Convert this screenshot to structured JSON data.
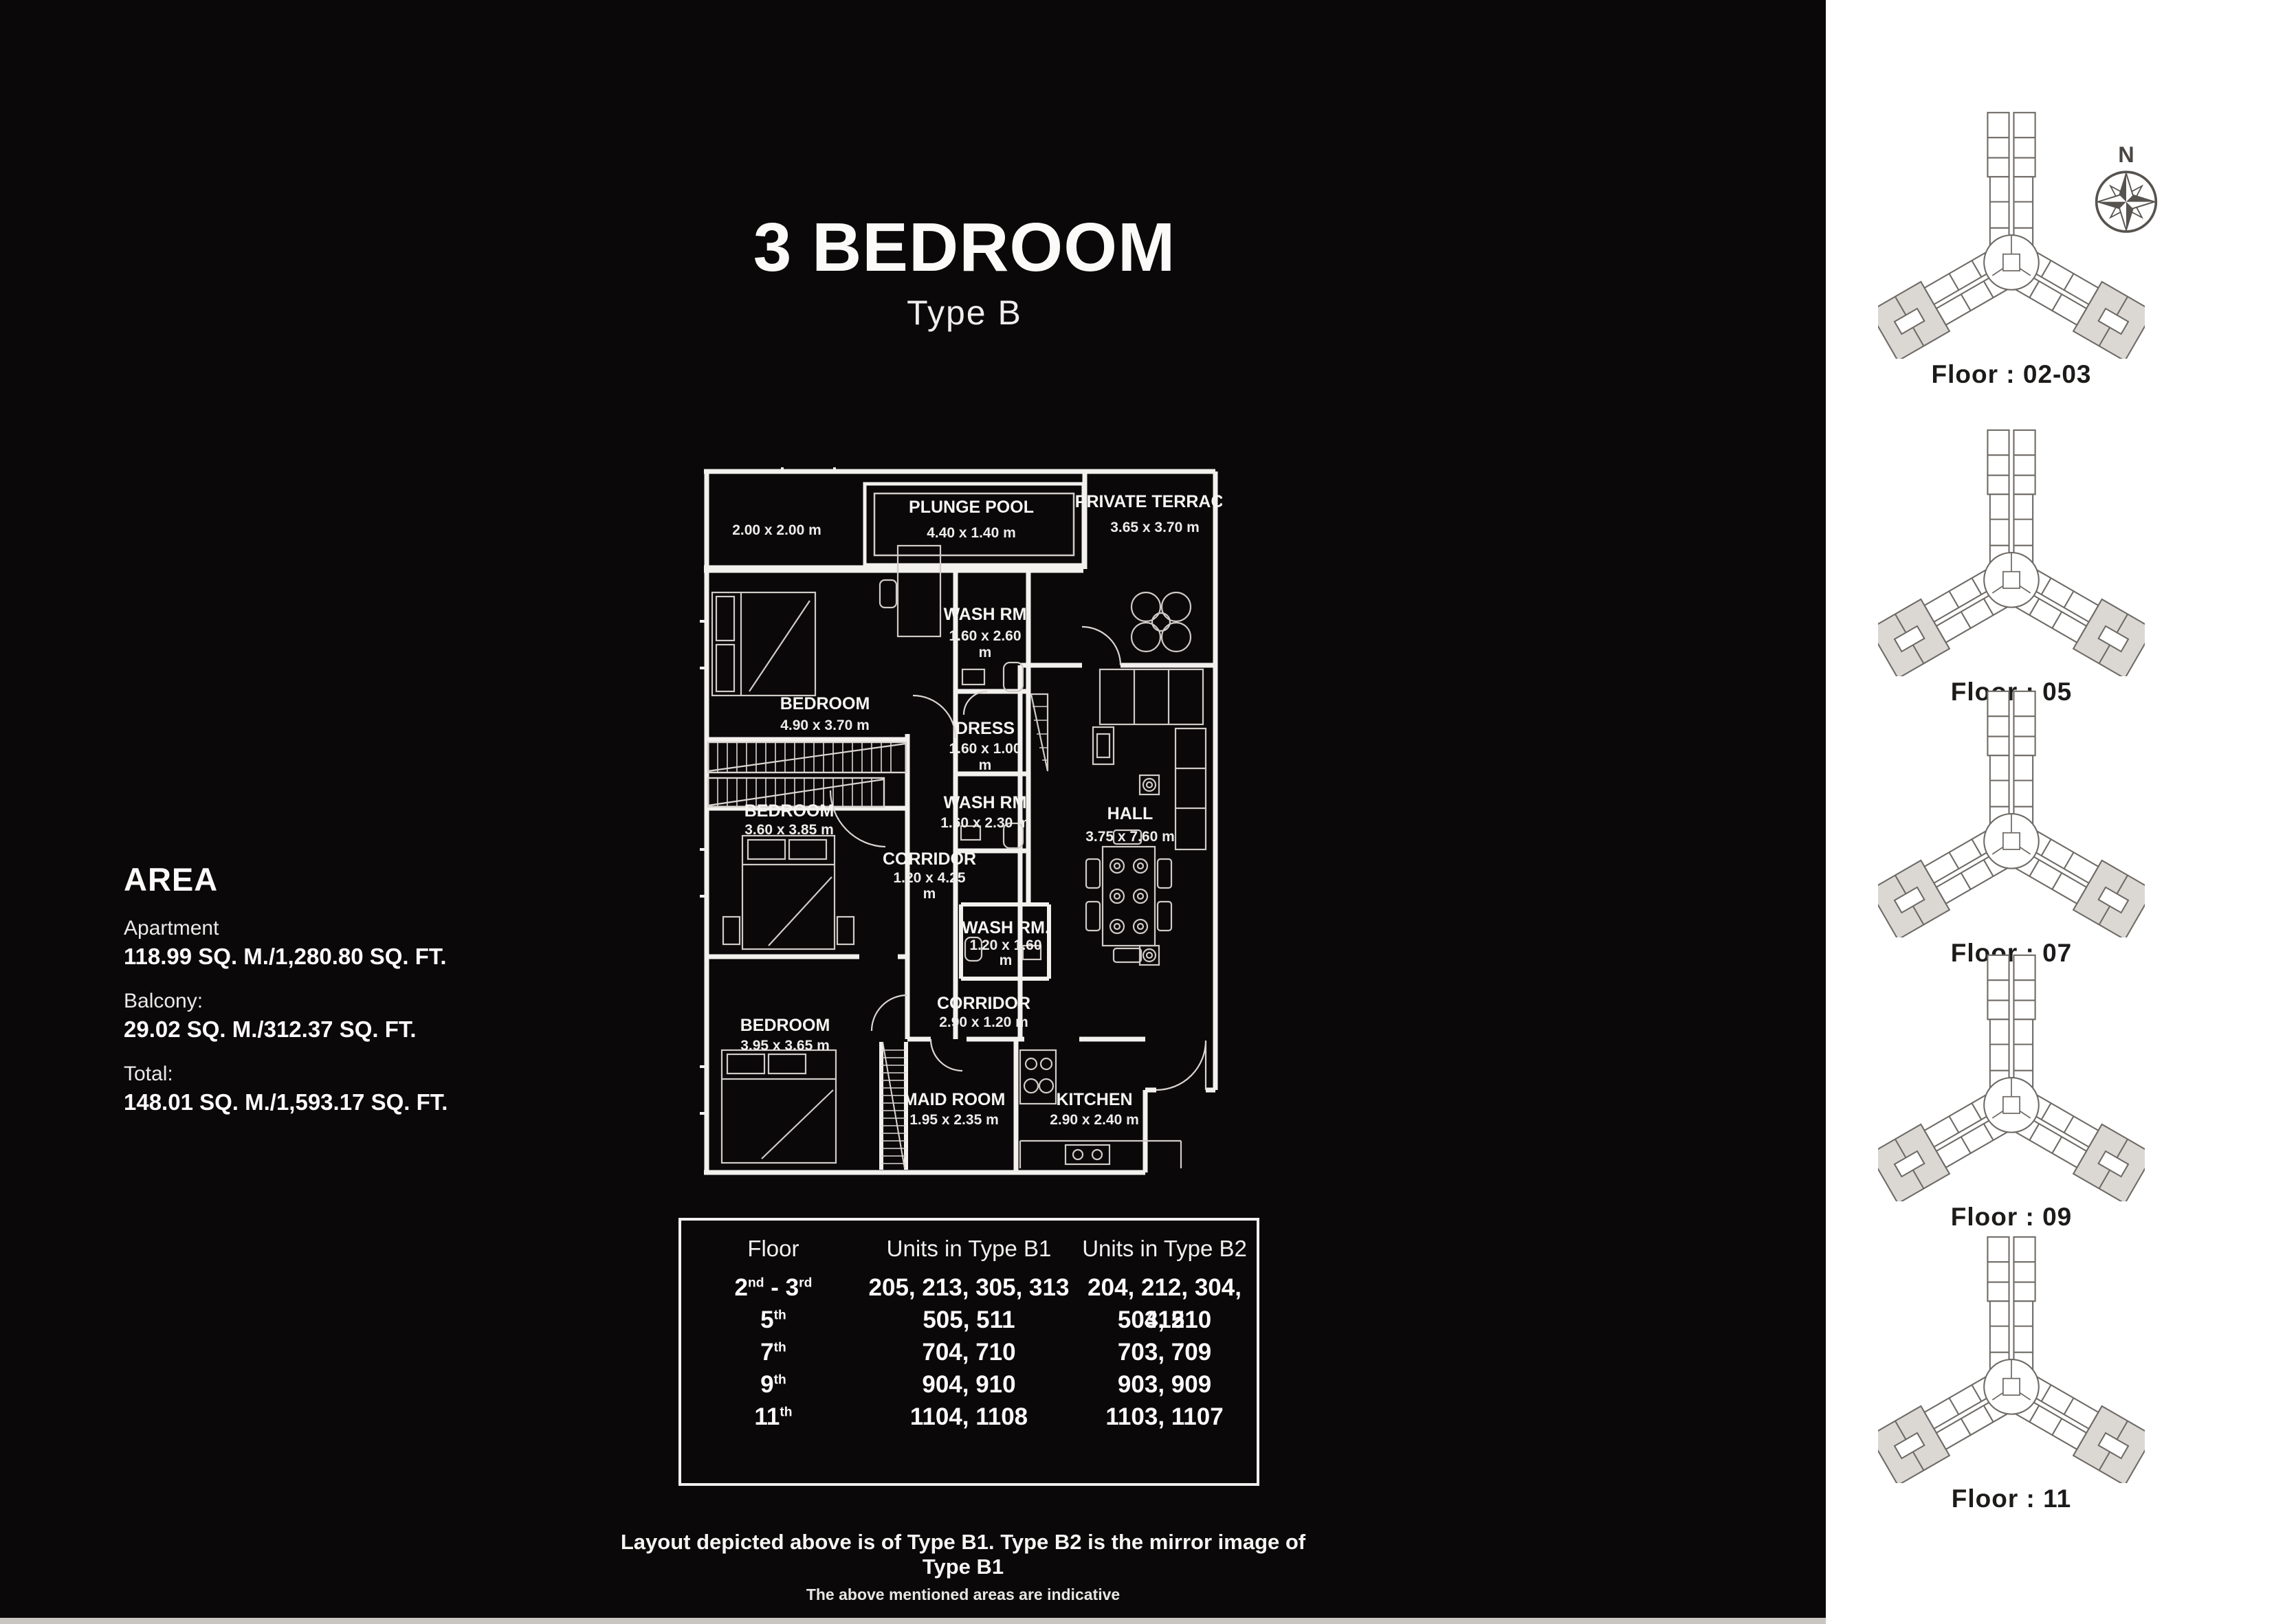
{
  "title": {
    "main": "3 BEDROOM",
    "sub": "Type B"
  },
  "area": {
    "heading": "AREA",
    "items": [
      {
        "label": "Apartment",
        "value": "118.99 SQ. M./1,280.80 SQ. FT."
      },
      {
        "label": "Balcony:",
        "value": "29.02 SQ. M./312.37 SQ. FT."
      },
      {
        "label": "Total:",
        "value": "148.01 SQ. M./1,593.17 SQ. FT."
      }
    ]
  },
  "plan": {
    "rooms": {
      "plunge_pool": {
        "name": "PLUNGE POOL",
        "dims": "4.40 x 1.40 m"
      },
      "terrace": {
        "name": "PRIVATE TERRACE",
        "dims": "3.65 x 3.70 m"
      },
      "balcony": {
        "dims": "2.00 x 2.00 m"
      },
      "bedroom1": {
        "name": "BEDROOM",
        "dims": "4.90 x 3.70 m"
      },
      "washrm1": {
        "name": "WASH RM",
        "dims": "1.60 x 2.60",
        "unit": "m"
      },
      "dress": {
        "name": "DRESS",
        "dims": "1.60 x 1.00",
        "unit": "m"
      },
      "washrm2": {
        "name": "WASH RM",
        "dims": "1.60 x 2.30 m"
      },
      "bedroom2": {
        "name": "BEDROOM",
        "dims": "3.60 x 3.85 m"
      },
      "corridor1": {
        "name": "CORRIDOR",
        "dims": "1.20 x 4.25",
        "unit": "m"
      },
      "hall": {
        "name": "HALL",
        "dims": "3.75 x 7.60 m"
      },
      "washrm3": {
        "name": "WASH RM.",
        "dims": "1.20 x 1.60",
        "unit": "m"
      },
      "corridor2": {
        "name": "CORRIDOR",
        "dims": "2.90 x 1.20 m"
      },
      "bedroom3": {
        "name": "BEDROOM",
        "dims": "3.95 x 3.65 m"
      },
      "maid_room": {
        "name": "MAID ROOM",
        "dims": "1.95 x 2.35 m"
      },
      "kitchen": {
        "name": "KITCHEN",
        "dims": "2.90 x 2.40 m"
      }
    }
  },
  "units_table": {
    "headers": [
      "Floor",
      "Units in Type B1",
      "Units in Type B2"
    ],
    "rows": [
      {
        "floor": [
          {
            "t": "2"
          },
          {
            "t": "nd",
            "sup": true
          },
          {
            "t": " - 3"
          },
          {
            "t": "rd",
            "sup": true
          }
        ],
        "b1": "205, 213, 305, 313",
        "b2": "204, 212, 304, 312"
      },
      {
        "floor": [
          {
            "t": "5"
          },
          {
            "t": "th",
            "sup": true
          }
        ],
        "b1": "505, 511",
        "b2": "504, 510"
      },
      {
        "floor": [
          {
            "t": "7"
          },
          {
            "t": "th",
            "sup": true
          }
        ],
        "b1": "704, 710",
        "b2": "703, 709"
      },
      {
        "floor": [
          {
            "t": "9"
          },
          {
            "t": "th",
            "sup": true
          }
        ],
        "b1": "904, 910",
        "b2": "903, 909"
      },
      {
        "floor": [
          {
            "t": "11"
          },
          {
            "t": "th",
            "sup": true
          }
        ],
        "b1": "1104, 1108",
        "b2": "1103, 1107"
      }
    ]
  },
  "notes": {
    "line1": "Layout depicted above is of Type B1. Type B2 is the mirror image of Type B1",
    "line2": "The above mentioned areas are indicative"
  },
  "sidebar": {
    "compass_label": "N",
    "floors": [
      {
        "label": "Floor : 02-03"
      },
      {
        "label": "Floor : 05"
      },
      {
        "label": "Floor : 07"
      },
      {
        "label": "Floor : 09"
      },
      {
        "label": "Floor : 11"
      }
    ]
  },
  "colors": {
    "background": "#0a0809",
    "plan_lines": "#f3f1ee",
    "sidebar_bg": "#ffffff",
    "diagram_stroke": "#6e6a66",
    "diagram_highlight": "#dbd7d3",
    "bottom_strip": "#c9c5c1"
  }
}
